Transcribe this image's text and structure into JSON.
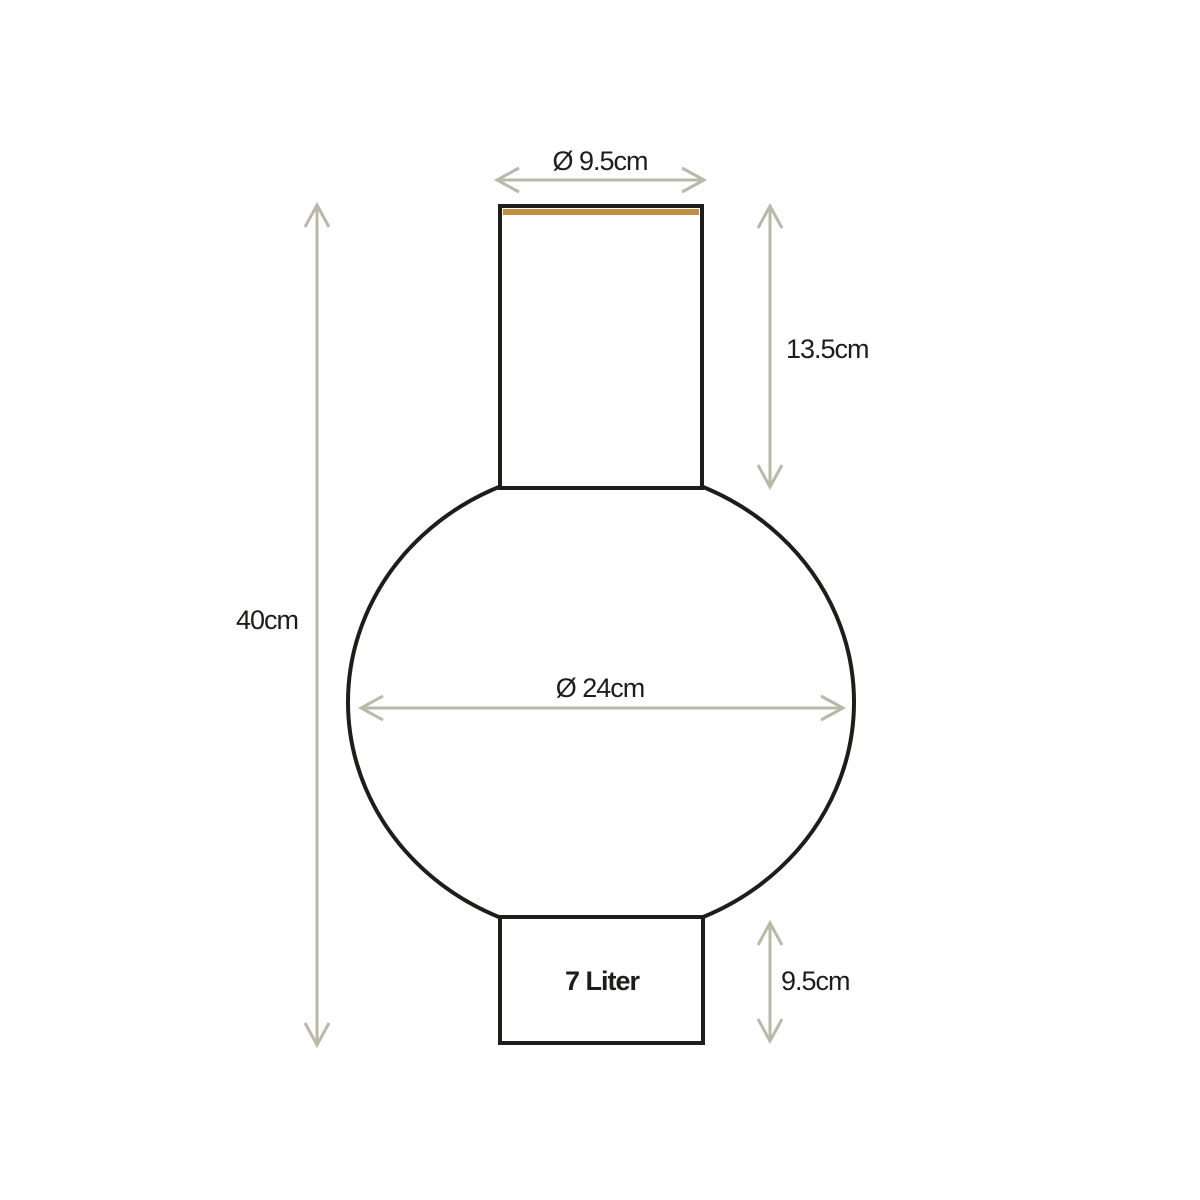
{
  "diagram": {
    "labels": {
      "top_diameter": "Ø 9.5cm",
      "neck_height": "13.5cm",
      "total_height": "40cm",
      "body_diameter": "Ø 24cm",
      "capacity": "7 Liter",
      "base_height": "9.5cm"
    },
    "colors": {
      "outline": "#1d1d1b",
      "dimension": "#b9b9aa",
      "rim_accent": "#c28f42",
      "background": "#ffffff"
    }
  }
}
